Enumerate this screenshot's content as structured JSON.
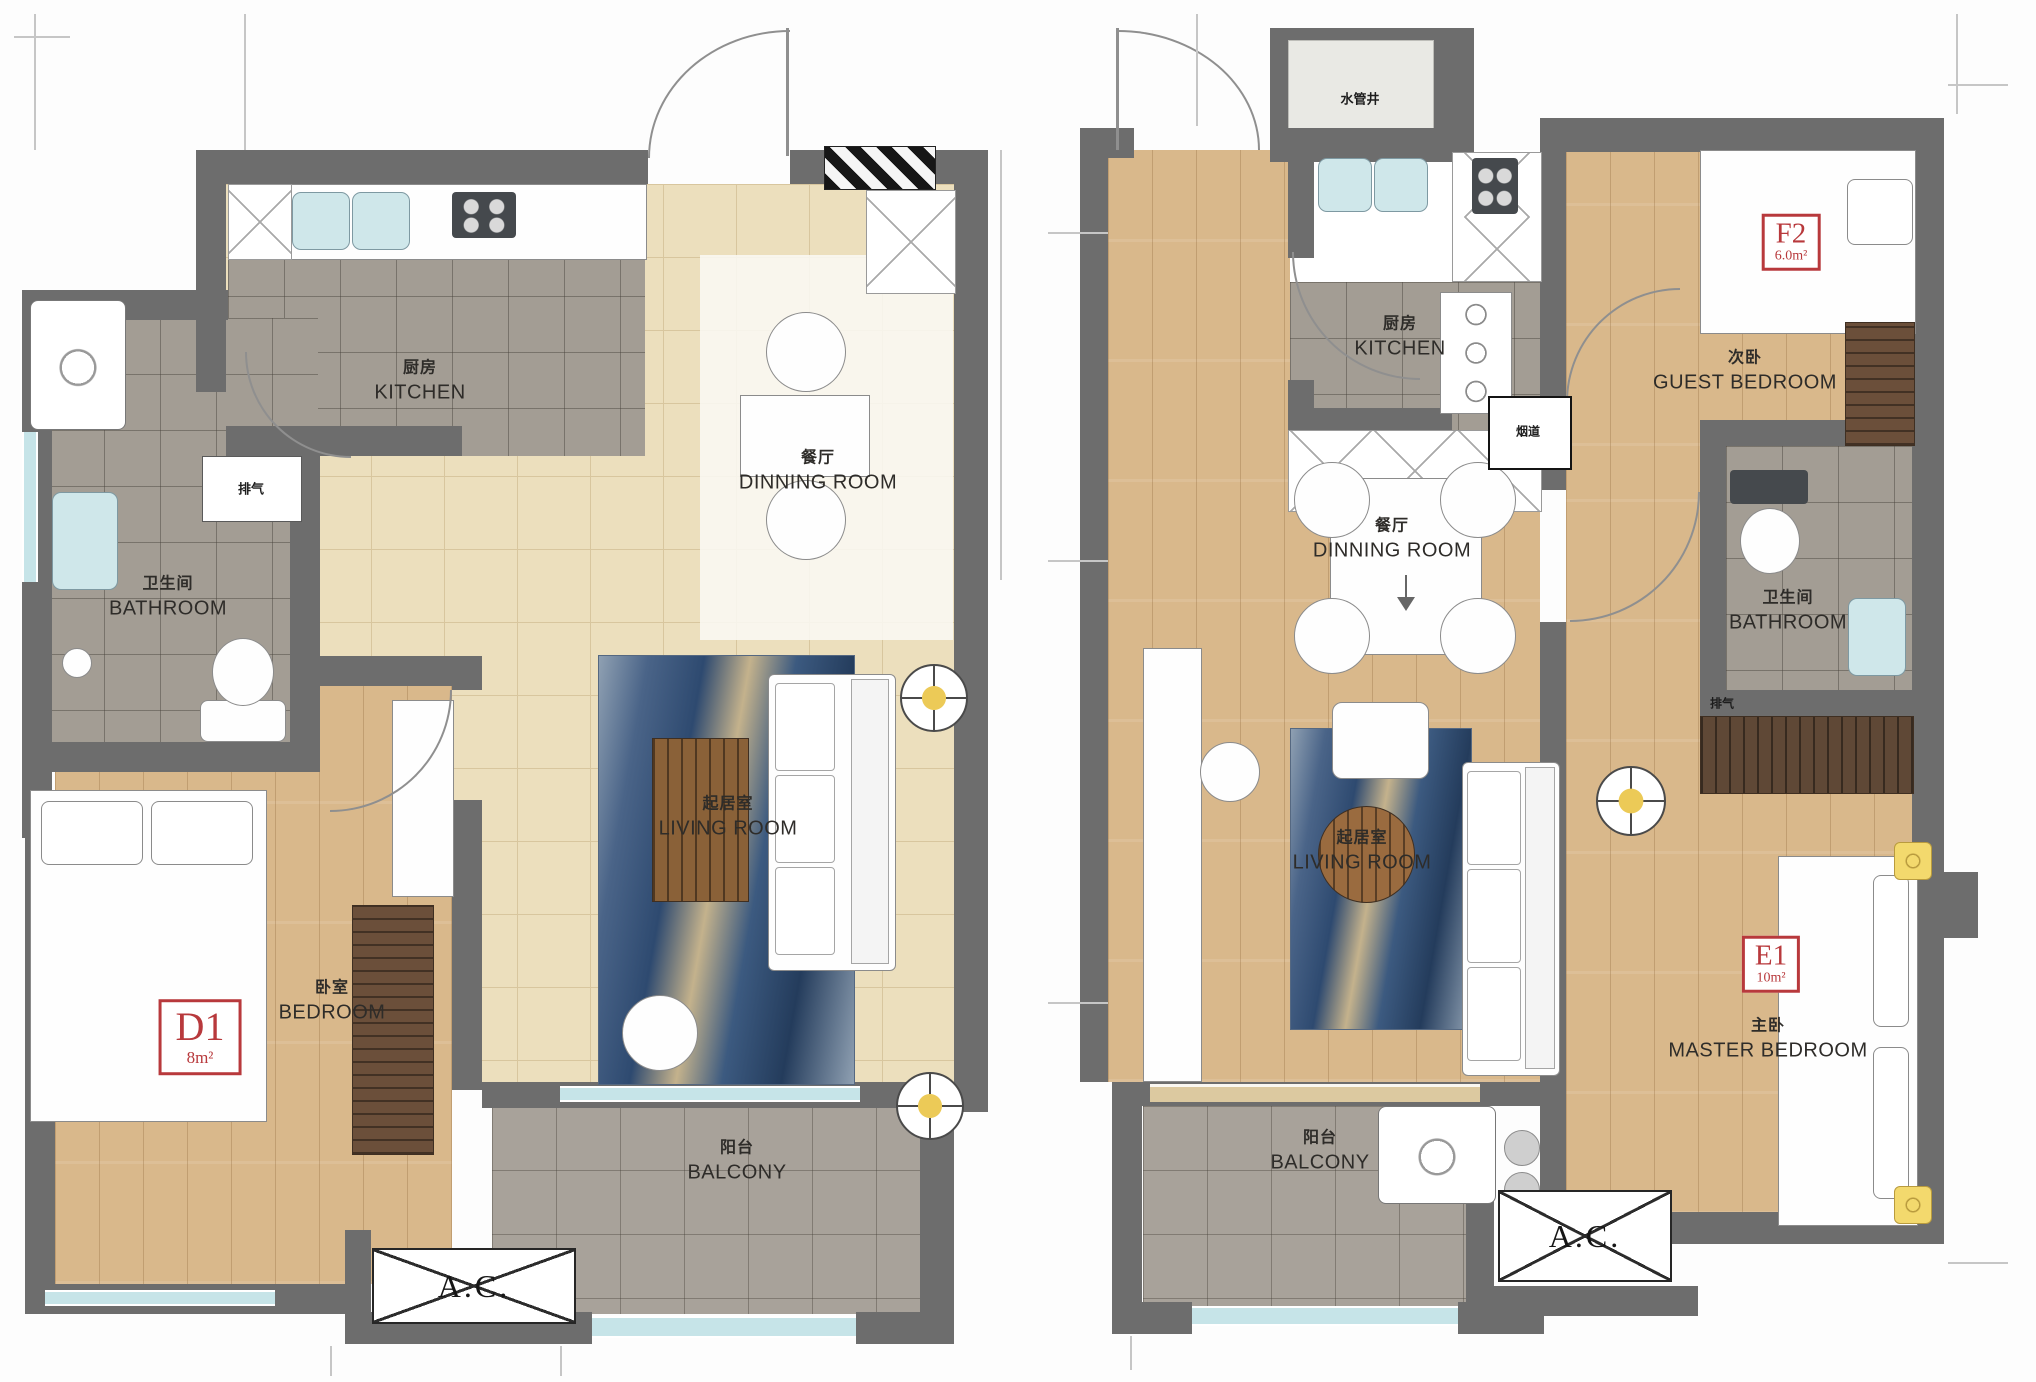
{
  "left_plan": {
    "unit": {
      "code": "D1",
      "area": "8m²"
    },
    "rooms": {
      "kitchen": {
        "cn": "厨房",
        "en": "KITCHEN"
      },
      "dining": {
        "cn": "餐厅",
        "en": "DINNING ROOM"
      },
      "bathroom": {
        "cn": "卫生间",
        "en": "BATHROOM"
      },
      "living": {
        "cn": "起居室",
        "en": "LIVING ROOM"
      },
      "bedroom": {
        "cn": "卧室",
        "en": "BEDROOM"
      },
      "balcony": {
        "cn": "阳台",
        "en": "BALCONY"
      }
    },
    "annotations": {
      "exhaust": "排气",
      "ac": "A.C."
    }
  },
  "right_plan": {
    "units": {
      "guest_room": {
        "code": "F2",
        "area": "6.0m²"
      },
      "master_room": {
        "code": "E1",
        "area": "10m²"
      }
    },
    "rooms": {
      "kitchen": {
        "cn": "厨房",
        "en": "KITCHEN"
      },
      "dining": {
        "cn": "餐厅",
        "en": "DINNING ROOM"
      },
      "bathroom": {
        "cn": "卫生间",
        "en": "BATHROOM"
      },
      "living": {
        "cn": "起居室",
        "en": "LIVING ROOM"
      },
      "guest_bedroom": {
        "cn": "次卧",
        "en": "GUEST BEDROOM"
      },
      "master_bedroom": {
        "cn": "主卧",
        "en": "MASTER BEDROOM"
      },
      "balcony": {
        "cn": "阳台",
        "en": "BALCONY"
      }
    },
    "annotations": {
      "water_shaft": "水管井",
      "flue": "烟道",
      "exhaust": "排气",
      "ac": "A.C."
    }
  },
  "colors": {
    "wall": "#6d6d6d",
    "accent_red": "#b8393c",
    "wood": "#d9b88b",
    "tile_gray": "#a39d94",
    "tile_beige": "#ecdfbd",
    "glazing": "#c6e4e8"
  }
}
